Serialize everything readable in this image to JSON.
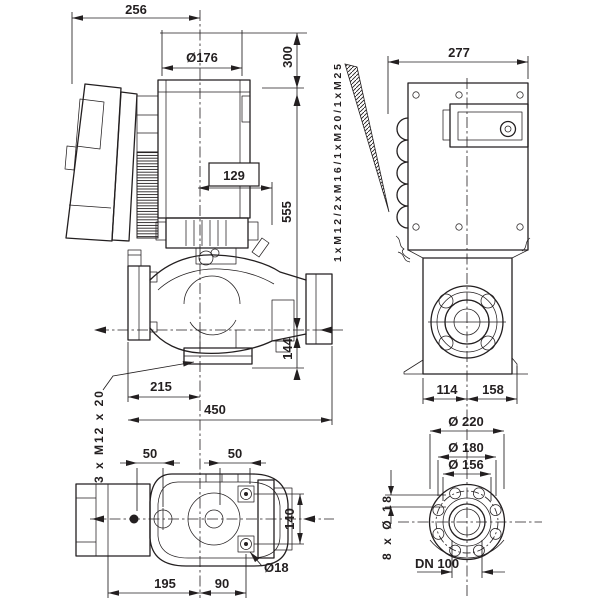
{
  "side_view": {
    "dim_width_top": "256",
    "dim_motor_dia": "Ø176",
    "dim_height_upper": "300",
    "dim_height_total": "555",
    "dim_center_to_base": "144",
    "dim_seal_callout": "129",
    "dim_flange_to_center": "215",
    "dim_port_to_port": "450",
    "label_foot_thread": "3 x M12 x 20"
  },
  "rear_view": {
    "dim_width": "277",
    "label_cable_glands": "1xM12/2xM16/1xM20/1xM25",
    "dim_center_to_left": "114",
    "dim_center_to_right": "158"
  },
  "top_view": {
    "dim_hole_left": "50",
    "dim_hole_right": "50",
    "dim_bolt_spacing": "140",
    "label_hole_dia": "Ø18",
    "dim_length_left": "195",
    "dim_length_right": "90"
  },
  "flange_view": {
    "dim_outer_dia": "Ø 220",
    "dim_bolt_circle": "Ø 180",
    "dim_neck_dia": "Ø 156",
    "label_bolt_holes": "8 x Ø 18",
    "label_nominal": "DN 100"
  },
  "colors": {
    "line": "#231f20",
    "background": "#ffffff"
  }
}
